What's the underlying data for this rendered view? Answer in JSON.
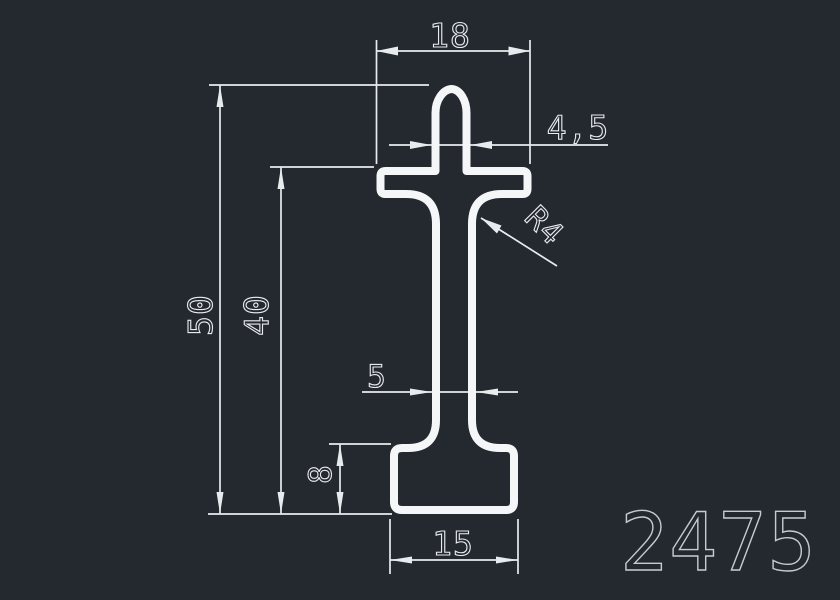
{
  "drawing": {
    "part_number": "2475",
    "dimensions": {
      "top_width": "18",
      "stem_width": "4,5",
      "corner_radius": "R4",
      "overall_height": "50",
      "upper_height": "40",
      "web_thickness": "5",
      "base_height": "8",
      "base_width": "15"
    },
    "colors": {
      "background": "#24282f",
      "profile_outline": "#f4f6f8",
      "dimension_lines": "#e8ebee",
      "part_number_text": "#c6cbd2"
    }
  }
}
